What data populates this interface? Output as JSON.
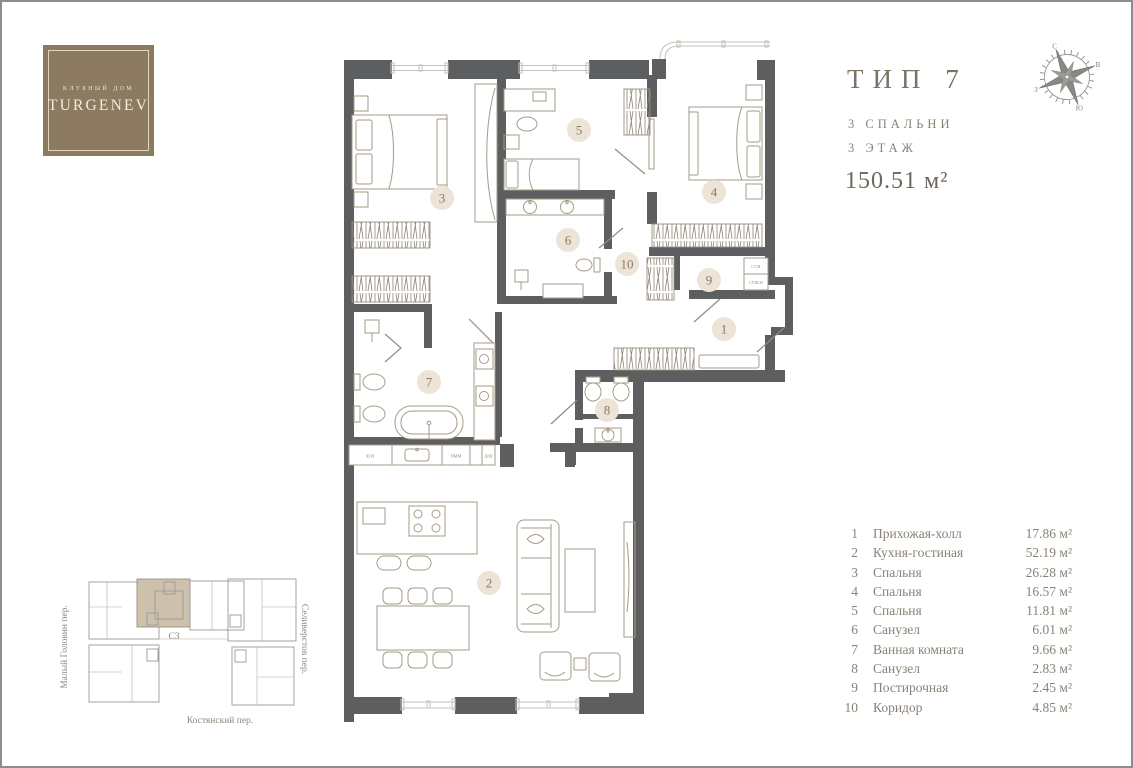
{
  "logo": {
    "top": "КЛУБНЫЙ ДОМ",
    "brand": "TURGENEV"
  },
  "title": {
    "type": "ТИП 7",
    "bedrooms": "3 СПАЛЬНИ",
    "floor": "3 ЭТАЖ",
    "area": "150.51 м²"
  },
  "compass": {
    "n": "С",
    "e": "В",
    "s": "Ю",
    "w": "З"
  },
  "plan": {
    "room_numbers": [
      "1",
      "2",
      "3",
      "4",
      "5",
      "6",
      "7",
      "8",
      "9",
      "10"
    ],
    "appliances": {
      "washer": "СТ.М",
      "dryer": "СУШ.М",
      "fridge": "ХОЛ",
      "dishwasher": "ПММ",
      "oven": "Д/Ш"
    }
  },
  "legend": {
    "rows": [
      {
        "num": "1",
        "name": "Прихожая-холл",
        "area": "17.86 м²"
      },
      {
        "num": "2",
        "name": "Кухня-гостиная",
        "area": "52.19 м²"
      },
      {
        "num": "3",
        "name": "Спальня",
        "area": "26.28 м²"
      },
      {
        "num": "4",
        "name": "Спальня",
        "area": "16.57 м²"
      },
      {
        "num": "5",
        "name": "Спальня",
        "area": "11.81 м²"
      },
      {
        "num": "6",
        "name": "Санузел",
        "area": "6.01 м²"
      },
      {
        "num": "7",
        "name": "Ванная комната",
        "area": "9.66 м²"
      },
      {
        "num": "8",
        "name": "Санузел",
        "area": "2.83 м²"
      },
      {
        "num": "9",
        "name": "Постирочная",
        "area": "2.45 м²"
      },
      {
        "num": "10",
        "name": "Коридор",
        "area": "4.85 м²"
      }
    ]
  },
  "site": {
    "street_left": "Малый Головин пер.",
    "street_right": "Селиверстов пер.",
    "street_bottom": "Костянский пер.",
    "section": "С3"
  },
  "colors": {
    "wall": "#5d5e60",
    "brand_brown": "#8c7a61",
    "circle_beige": "#ebe4d7",
    "furniture": "#a69b85"
  }
}
